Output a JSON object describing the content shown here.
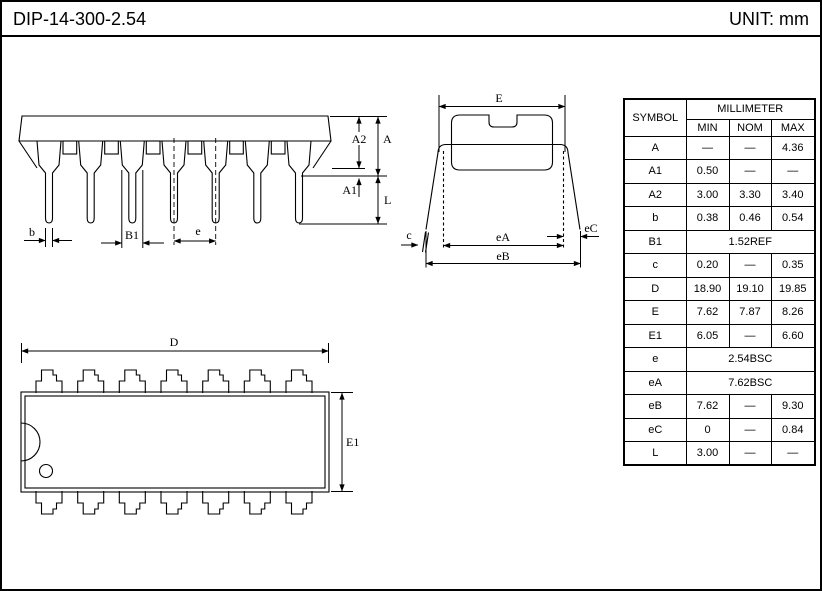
{
  "header": {
    "title": "DIP-14-300-2.54",
    "unit_label": "UNIT: mm"
  },
  "drawings": {
    "side_view": {
      "labels": {
        "b": "b",
        "b1": "B1",
        "e": "e",
        "a2": "A2",
        "a": "A",
        "a1": "A1",
        "l": "L"
      }
    },
    "end_view": {
      "labels": {
        "e_body": "E",
        "ea": "eA",
        "eb": "eB",
        "ec": "eC",
        "c": "c"
      }
    },
    "top_view": {
      "labels": {
        "d": "D",
        "e1": "E1"
      }
    }
  },
  "table": {
    "header": {
      "symbol": "SYMBOL",
      "group": "MILLIMETER",
      "columns": [
        "MIN",
        "NOM",
        "MAX"
      ]
    },
    "rows": [
      {
        "symbol": "A",
        "min": "—",
        "nom": "—",
        "max": "4.36"
      },
      {
        "symbol": "A1",
        "min": "0.50",
        "nom": "—",
        "max": "—"
      },
      {
        "symbol": "A2",
        "min": "3.00",
        "nom": "3.30",
        "max": "3.40"
      },
      {
        "symbol": "b",
        "min": "0.38",
        "nom": "0.46",
        "max": "0.54"
      },
      {
        "symbol": "B1",
        "span": "1.52REF"
      },
      {
        "symbol": "c",
        "min": "0.20",
        "nom": "—",
        "max": "0.35"
      },
      {
        "symbol": "D",
        "min": "18.90",
        "nom": "19.10",
        "max": "19.85"
      },
      {
        "symbol": "E",
        "min": "7.62",
        "nom": "7.87",
        "max": "8.26"
      },
      {
        "symbol": "E1",
        "min": "6.05",
        "nom": "—",
        "max": "6.60"
      },
      {
        "symbol": "e",
        "span": "2.54BSC"
      },
      {
        "symbol": "eA",
        "span": "7.62BSC"
      },
      {
        "symbol": "eB",
        "min": "7.62",
        "nom": "—",
        "max": "9.30"
      },
      {
        "symbol": "eC",
        "min": "0",
        "nom": "—",
        "max": "0.84"
      },
      {
        "symbol": "L",
        "min": "3.00",
        "nom": "—",
        "max": "—"
      }
    ]
  }
}
